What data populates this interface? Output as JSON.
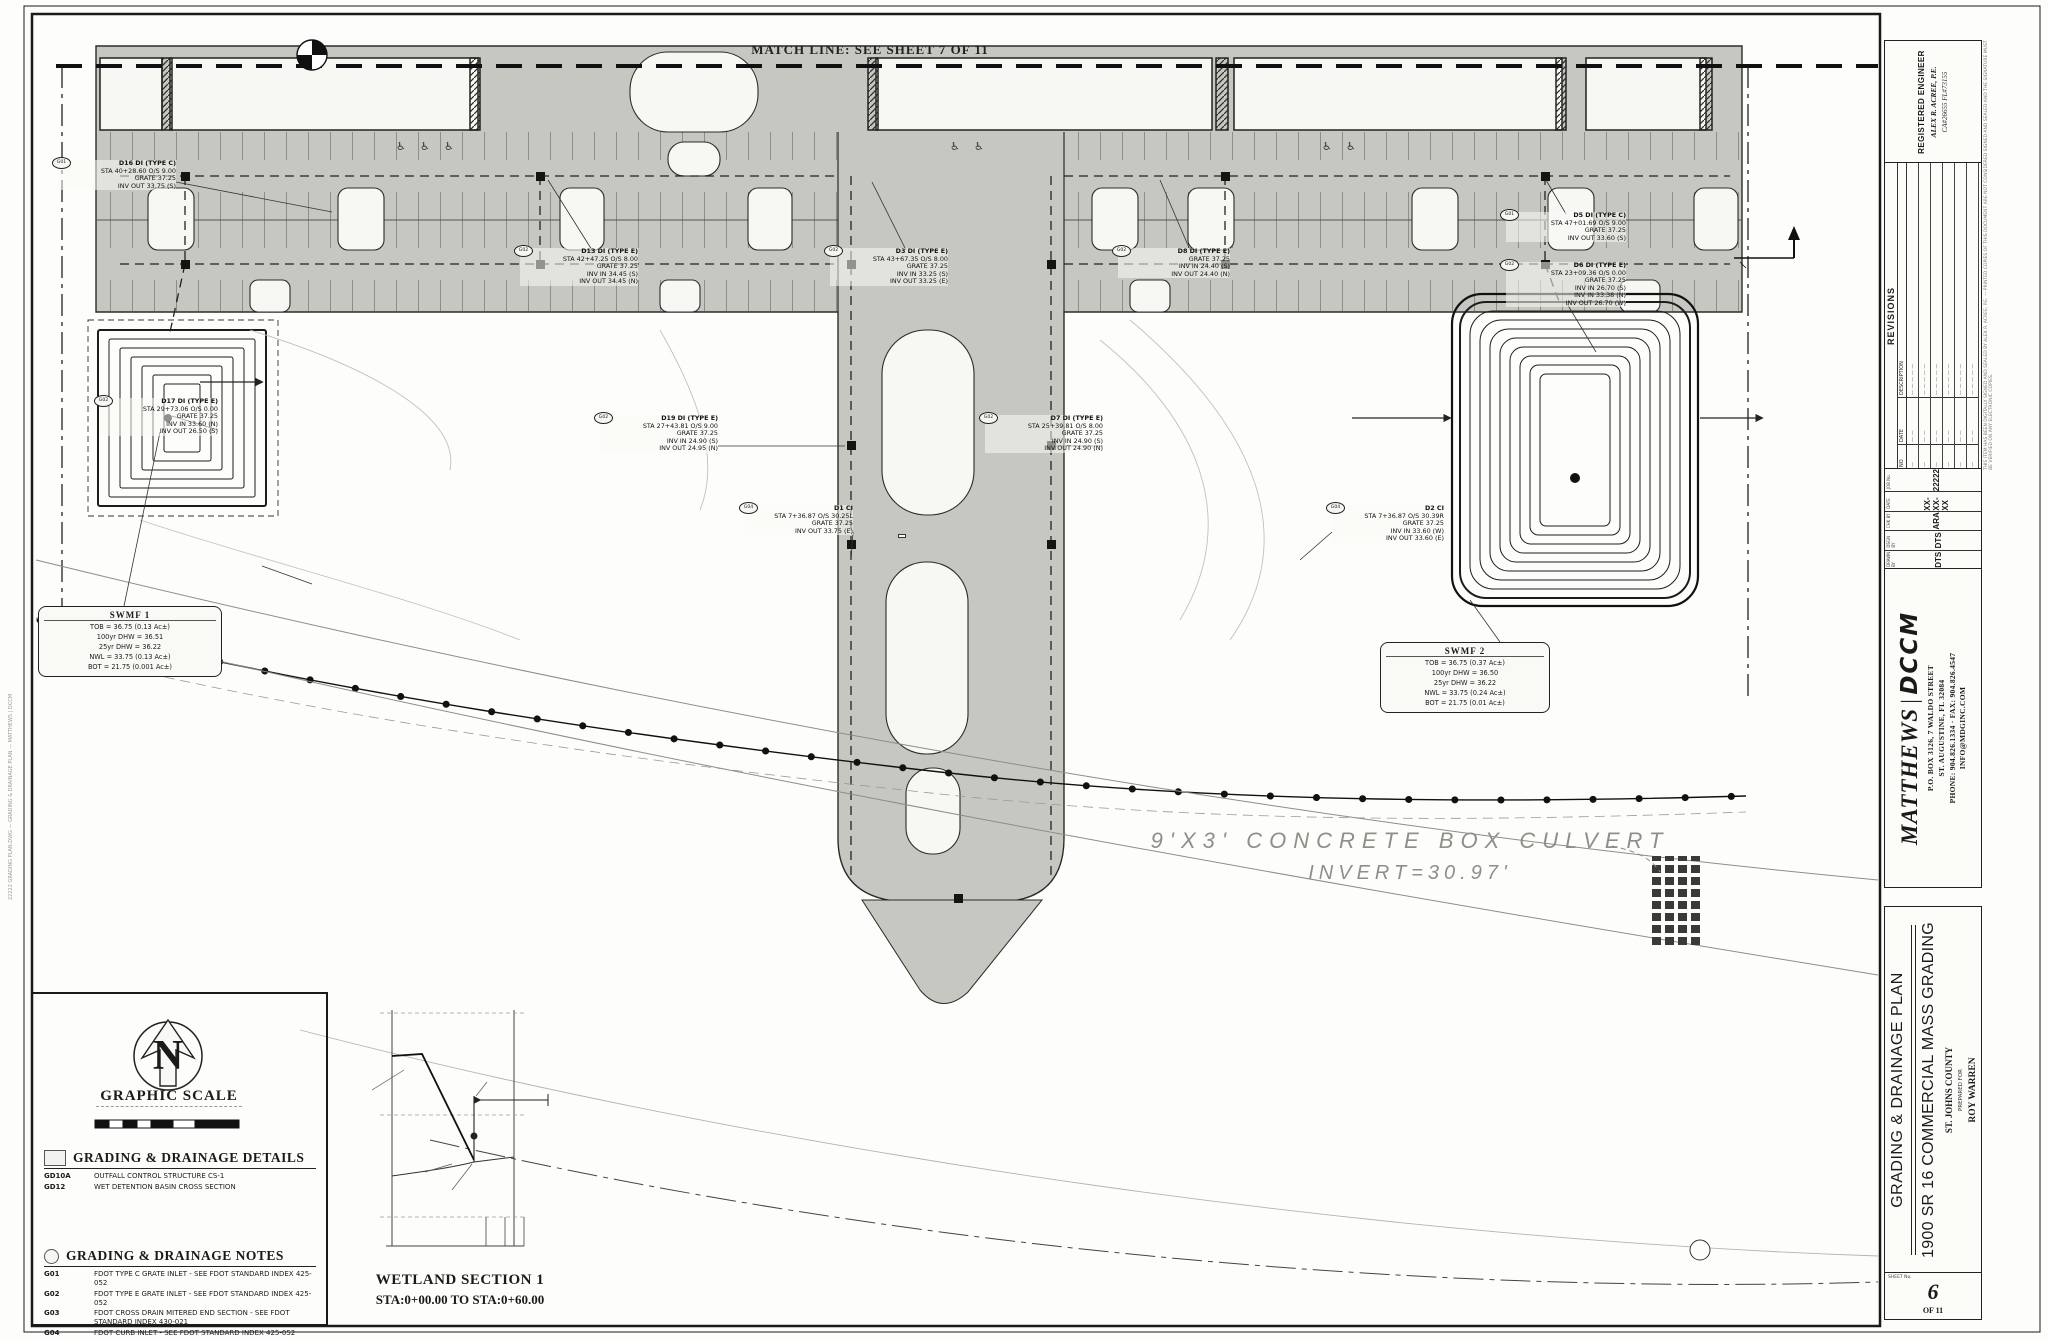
{
  "sheet": {
    "match_line_label": "MATCH LINE: SEE SHEET 7 OF 11",
    "culvert_line1": "9'X3' CONCRETE BOX CULVERT",
    "culvert_line2": "INVERT=30.97'",
    "plot_stamp": "22222 GRADING PLAN.DWG — GRADING & DRAINAGE PLAN — MATTHEWS | DCCM",
    "accessible_icon": "♿"
  },
  "legend": {
    "north": "N",
    "graphic_scale_title": "GRAPHIC SCALE",
    "scale_note": "1\" = 30'",
    "details_title": "GRADING & DRAINAGE DETAILS",
    "details": [
      {
        "code": "GD10A",
        "text": "OUTFALL CONTROL STRUCTURE CS-1"
      },
      {
        "code": "GD12",
        "text": "WET DETENTION BASIN CROSS SECTION"
      }
    ],
    "notes_title": "GRADING & DRAINAGE NOTES",
    "notes": [
      {
        "code": "G01",
        "text": "FDOT TYPE C GRATE INLET - SEE FDOT STANDARD INDEX 425-052"
      },
      {
        "code": "G02",
        "text": "FDOT TYPE E GRATE INLET - SEE FDOT STANDARD INDEX 425-052"
      },
      {
        "code": "G03",
        "text": "FDOT CROSS DRAIN MITERED END SECTION - SEE FDOT STANDARD INDEX 430-021"
      },
      {
        "code": "G04",
        "text": "FDOT CURB INLET - SEE FDOT STANDARD INDEX 425-052"
      }
    ]
  },
  "wetland_section": {
    "title_line1": "WETLAND SECTION 1",
    "title_line2": "STA:0+00.00 TO STA:0+60.00"
  },
  "swmf_boxes": [
    {
      "x": 38,
      "y": 606,
      "w": 172,
      "title": "SWMF 1",
      "lines": [
        "TOB = 36.75 (0.13 Ac±)",
        "100yr DHW = 36.51",
        "25yr DHW = 36.22",
        "NWL = 33.75 (0.13 Ac±)",
        "BOT = 21.75 (0.001 Ac±)"
      ]
    },
    {
      "x": 1380,
      "y": 642,
      "w": 158,
      "title": "SWMF 2",
      "lines": [
        "TOB = 36.75 (0.37 Ac±)",
        "100yr DHW = 36.50",
        "25yr DHW = 36.22",
        "NWL = 33.75 (0.24 Ac±)",
        "BOT = 21.75 (0.01 Ac±)"
      ]
    }
  ],
  "callouts": [
    {
      "x": 58,
      "y": 160,
      "w": 118,
      "code": "G01",
      "lines": [
        "D16 DI (TYPE C)",
        "STA 40+28.60 O/S 9.00",
        "GRATE 37.25",
        "INV OUT 33.75 (S)"
      ]
    },
    {
      "x": 520,
      "y": 248,
      "w": 118,
      "code": "G02",
      "lines": [
        "D13 DI (TYPE E)",
        "STA 42+47.25 O/S 8.00",
        "GRATE 37.25",
        "INV IN 34.45 (S)",
        "INV OUT 34.45 (N)"
      ]
    },
    {
      "x": 830,
      "y": 248,
      "w": 118,
      "code": "G02",
      "lines": [
        "D3 DI (TYPE E)",
        "STA 43+67.35 O/S 8.00",
        "GRATE 37.25",
        "INV IN 33.25 (S)",
        "INV OUT 33.25 (E)"
      ]
    },
    {
      "x": 1118,
      "y": 248,
      "w": 112,
      "code": "G02",
      "lines": [
        "D8 DI (TYPE E)",
        "GRATE 37.25",
        "INV IN 24.40 (S)",
        "INV OUT 24.40 (N)"
      ]
    },
    {
      "x": 1506,
      "y": 212,
      "w": 120,
      "code": "G01",
      "lines": [
        "D5 DI (TYPE C)",
        "STA 47+01.69 O/S 9.00",
        "GRATE 37.25",
        "INV OUT 33.60 (S)"
      ]
    },
    {
      "x": 1506,
      "y": 262,
      "w": 120,
      "code": "G02",
      "lines": [
        "D6 DI (TYPE E)",
        "STA 23+09.36 O/S 0.00",
        "GRATE 37.25",
        "INV IN 26.70 (S)",
        "INV IN 33.38 (N)",
        "INV OUT 26.70 (W)"
      ]
    },
    {
      "x": 100,
      "y": 398,
      "w": 118,
      "code": "G02",
      "lines": [
        "D17 DI (TYPE E)",
        "STA 29+73.06 O/S 0.00",
        "GRATE 37.25",
        "INV IN 33.60 (N)",
        "INV OUT 26.50 (S)"
      ]
    },
    {
      "x": 600,
      "y": 415,
      "w": 118,
      "code": "G02",
      "lines": [
        "D19 DI (TYPE E)",
        "STA 27+43.81 O/S 9.00",
        "GRATE 37.25",
        "INV IN 24.90 (S)",
        "INV OUT 24.95 (N)"
      ]
    },
    {
      "x": 985,
      "y": 415,
      "w": 118,
      "code": "G02",
      "lines": [
        "D7 DI (TYPE E)",
        "STA 25+39.81 O/S 8.00",
        "GRATE 37.25",
        "INV IN 24.90 (S)",
        "INV OUT 24.90 (N)"
      ]
    },
    {
      "x": 745,
      "y": 505,
      "w": 108,
      "code": "G04",
      "lines": [
        "D1 CI",
        "STA 7+36.87 O/S 30.25L",
        "GRATE 37.25",
        "INV OUT 33.75 (E)"
      ]
    },
    {
      "x": 1332,
      "y": 505,
      "w": 112,
      "code": "G04",
      "lines": [
        "D2 CI",
        "STA 7+36.87 O/S 30.39R",
        "GRATE 37.25",
        "INV IN 33.60 (W)",
        "INV OUT 33.60 (E)"
      ]
    }
  ],
  "pipes": [
    {
      "x": 836,
      "y": 162,
      "lines": [
        "18\" PP",
        "65 LF @ 0.24%"
      ]
    },
    {
      "x": 898,
      "y": 534,
      "boxed": true,
      "lines": [
        "16\" PP",
        "61 LF @ 0.25%"
      ]
    },
    {
      "x": 1282,
      "y": 322,
      "lines": [
        "20\" PP",
        "229 LF @ 0.41%"
      ]
    },
    {
      "x": 262,
      "y": 302,
      "lines": [
        "30\" PP",
        "225 LF @ 0.41%"
      ]
    },
    {
      "x": 176,
      "y": 330,
      "rot": -78,
      "lines": [
        "24\" PP @ 0.41%"
      ]
    },
    {
      "x": 1216,
      "y": 335,
      "rot": -80,
      "lines": [
        "24\" PP @ 0.45%"
      ]
    }
  ],
  "spots": [
    {
      "x": 28,
      "y": 84,
      "label": "(38.3)"
    },
    {
      "x": 44,
      "y": 102,
      "label": "(37.3)"
    },
    {
      "x": 50,
      "y": 122,
      "label": "(38.0)"
    },
    {
      "x": 8,
      "y": 134,
      "label": "(39.4)"
    },
    {
      "x": 16,
      "y": 150,
      "label": "(40.3)"
    },
    {
      "x": 26,
      "y": 240,
      "label": "(37.4)"
    },
    {
      "x": 38,
      "y": 256,
      "label": "(39.9)"
    },
    {
      "x": 42,
      "y": 271,
      "label": "(37.9)"
    },
    {
      "x": 10,
      "y": 432,
      "label": "(38.6)"
    },
    {
      "x": 22,
      "y": 450,
      "label": "(39.8)"
    },
    {
      "x": 8,
      "y": 554,
      "label": "(40.0)"
    },
    {
      "x": 1068,
      "y": 136,
      "label": "(31.3)"
    },
    {
      "x": 1264,
      "y": 186,
      "label": "(31.8)"
    },
    {
      "x": 1476,
      "y": 224,
      "label": "(32.3)"
    },
    {
      "x": 1688,
      "y": 70,
      "label": "(33.2)"
    },
    {
      "x": 1736,
      "y": 76,
      "label": "(33.3)"
    },
    {
      "x": 1794,
      "y": 80,
      "label": "(33.4)"
    },
    {
      "x": 1174,
      "y": 268,
      "label": "(31.6)"
    },
    {
      "x": 1462,
      "y": 292,
      "label": "(32.2)"
    },
    {
      "x": 1348,
      "y": 278,
      "label": "(33.0)"
    },
    {
      "x": 1756,
      "y": 288,
      "label": "(32.5)"
    },
    {
      "x": 1552,
      "y": 332,
      "label": "(32.9)"
    },
    {
      "x": 1792,
      "y": 372,
      "label": "(32.1)"
    },
    {
      "x": 1142,
      "y": 368,
      "label": "(31.2)"
    },
    {
      "x": 1400,
      "y": 396,
      "label": "(32.4)"
    },
    {
      "x": 1194,
      "y": 474,
      "label": "(31.0)"
    },
    {
      "x": 1394,
      "y": 494,
      "label": "(31.9)"
    },
    {
      "x": 1178,
      "y": 558,
      "label": "(30.7)"
    },
    {
      "x": 1566,
      "y": 628,
      "label": "(32.5)"
    },
    {
      "x": 964,
      "y": 538,
      "label": "(33.5)"
    },
    {
      "x": 788,
      "y": 492,
      "label": "(34.1)"
    },
    {
      "x": 796,
      "y": 566,
      "label": "(34.8)"
    },
    {
      "x": 948,
      "y": 600,
      "label": "(31.4)"
    },
    {
      "x": 858,
      "y": 634,
      "label": "(34.9)"
    },
    {
      "x": 940,
      "y": 642,
      "label": "(31.6)"
    },
    {
      "x": 552,
      "y": 562,
      "label": "(36.5)"
    },
    {
      "x": 590,
      "y": 556,
      "label": "(36.4)"
    },
    {
      "x": 658,
      "y": 508,
      "label": "(35.7)"
    },
    {
      "x": 516,
      "y": 624,
      "label": "(36.9)"
    },
    {
      "x": 245,
      "y": 758,
      "label": "(38.18)",
      "op": 0.5
    },
    {
      "x": 310,
      "y": 784,
      "label": "(39.86)",
      "op": 0.5
    },
    {
      "x": 152,
      "y": 810,
      "label": "(39.44)",
      "op": 0.5
    },
    {
      "x": 540,
      "y": 834,
      "label": "(38.19)",
      "op": 0.5
    },
    {
      "x": 548,
      "y": 868,
      "label": "(38.61)",
      "op": 0.5
    },
    {
      "x": 738,
      "y": 898,
      "label": "(37.93)",
      "op": 0.5
    },
    {
      "x": 1026,
      "y": 928,
      "label": "(37.91)",
      "op": 0.5
    },
    {
      "x": 1168,
      "y": 948,
      "label": "(37.81)",
      "op": 0.5
    },
    {
      "x": 1148,
      "y": 1030,
      "label": "(38.54)",
      "op": 0.5
    }
  ],
  "micro": [
    {
      "x": 366,
      "y": 1007,
      "label": "40",
      "fs": 9
    },
    {
      "x": 527,
      "y": 1007,
      "label": "40",
      "fs": 9
    },
    {
      "x": 366,
      "y": 1109,
      "label": "35",
      "fs": 9
    },
    {
      "x": 527,
      "y": 1109,
      "label": "35",
      "fs": 9
    },
    {
      "x": 366,
      "y": 1211,
      "label": "30",
      "fs": 9
    },
    {
      "x": 527,
      "y": 1211,
      "label": "30",
      "fs": 9
    },
    {
      "x": 379,
      "y": 1250,
      "label": "0+00",
      "fs": 9
    },
    {
      "x": 497,
      "y": 1250,
      "label": "0+60",
      "fs": 9
    },
    {
      "x": 328,
      "y": 1084,
      "label": "PROPOSED GRADE",
      "fs": 7
    },
    {
      "x": 480,
      "y": 1079,
      "label": "SILT FENCE",
      "fs": 7
    },
    {
      "x": 553,
      "y": 1095,
      "label": "WETLAND",
      "fs": 7
    },
    {
      "x": 350,
      "y": 1169,
      "label": "EXISTING GRADE",
      "fs": 7
    },
    {
      "x": 397,
      "y": 1188,
      "label": "WETLAND LINE",
      "fs": 7
    },
    {
      "x": 427,
      "y": 1098,
      "label": "-18.22%",
      "fs": 6,
      "rot": 62
    },
    {
      "x": 398,
      "y": 1242,
      "label": "EG:37.5",
      "fs": 5,
      "rot": -90
    },
    {
      "x": 407,
      "y": 1242,
      "label": "PG:37.98",
      "fs": 5,
      "rot": -90
    },
    {
      "x": 492,
      "y": 1242,
      "label": "EG:",
      "fs": 5,
      "rot": -90
    },
    {
      "x": 501,
      "y": 1242,
      "label": "PG:32.68",
      "fs": 5,
      "rot": -90
    },
    {
      "x": 511,
      "y": 1242,
      "label": "EG:",
      "fs": 5,
      "rot": -90
    },
    {
      "x": 520,
      "y": 1242,
      "label": "PG:32.78",
      "fs": 5,
      "rot": -90
    },
    {
      "x": 336,
      "y": 164,
      "label": "41+00",
      "fs": 5
    },
    {
      "x": 476,
      "y": 164,
      "label": "42+00",
      "fs": 5
    },
    {
      "x": 616,
      "y": 164,
      "label": "43+00",
      "fs": 5
    },
    {
      "x": 756,
      "y": 164,
      "label": "44+00",
      "fs": 5
    },
    {
      "x": 1096,
      "y": 164,
      "label": "45+00",
      "fs": 5
    },
    {
      "x": 1236,
      "y": 164,
      "label": "46+00",
      "fs": 5
    },
    {
      "x": 1496,
      "y": 164,
      "label": "47+00",
      "fs": 5
    },
    {
      "x": 606,
      "y": 252,
      "label": "27+00",
      "fs": 5
    },
    {
      "x": 746,
      "y": 252,
      "label": "26+00",
      "fs": 5
    },
    {
      "x": 1086,
      "y": 252,
      "label": "25+00",
      "fs": 5
    },
    {
      "x": 1296,
      "y": 252,
      "label": "24+00",
      "fs": 5
    },
    {
      "x": 1536,
      "y": 252,
      "label": "23+00",
      "fs": 5
    },
    {
      "x": 316,
      "y": 578,
      "label": "PROPOSED 6' WOODEN FENCE",
      "fs": 7
    },
    {
      "x": 316,
      "y": 588,
      "label": "WITH 4' LOCKING GATE",
      "fs": 7
    },
    {
      "x": 1752,
      "y": 262,
      "label": "WETLAND SECTION 1",
      "fs": 7
    },
    {
      "x": 1694,
      "y": 1246,
      "label": "18",
      "fs": 8
    }
  ],
  "access_icon_positions": [
    {
      "x": 396,
      "y": 140
    },
    {
      "x": 420,
      "y": 140
    },
    {
      "x": 444,
      "y": 140
    },
    {
      "x": 950,
      "y": 140
    },
    {
      "x": 974,
      "y": 140
    },
    {
      "x": 1322,
      "y": 140
    },
    {
      "x": 1346,
      "y": 140
    }
  ],
  "scale_bar": {
    "ticks": [
      {
        "x": 92,
        "y": 1112,
        "label": "0",
        "fs": 8
      },
      {
        "x": 140,
        "y": 1112,
        "label": "30'",
        "fs": 8
      },
      {
        "x": 184,
        "y": 1112,
        "label": "45'",
        "fs": 8
      },
      {
        "x": 228,
        "y": 1112,
        "label": "60'",
        "fs": 8
      },
      {
        "x": 152,
        "y": 1140,
        "label": "1\" = 30'",
        "fs": 8
      }
    ]
  },
  "titleblock": {
    "engineer_line1": "REGISTERED ENGINEER",
    "engineer_line2": "ALEX R. ACREE, P.E.",
    "engineer_line3": "CA#26655  FL#73155",
    "seal_note": "THIS ITEM HAS BEEN DIGITALLY SIGNED AND SEALED BY ALEX R. ACREE, P.E. — PRINTED COPIES OF THIS DOCUMENT ARE NOT CONSIDERED SIGNED AND SEALED AND THE SIGNATURE MUST BE VERIFIED ON ANY ELECTRONIC COPIES.",
    "revisions": {
      "title": "REVISIONS",
      "col_no": "NO",
      "col_date": "DATE",
      "col_desc": "DESCRIPTION",
      "rows": [
        {
          "no": "—",
          "date": "— —",
          "desc": "— — — — —"
        },
        {
          "no": "—",
          "date": "— —",
          "desc": "— — — — —"
        },
        {
          "no": "—",
          "date": "— —",
          "desc": "— — — — —"
        },
        {
          "no": "—",
          "date": "— —",
          "desc": "— — — — —"
        },
        {
          "no": "—",
          "date": "— —",
          "desc": "— — — — —"
        },
        {
          "no": "—",
          "date": "— —",
          "desc": "— — — — —"
        }
      ]
    },
    "meta": [
      {
        "label": "DRAWN BY",
        "value": "DTS"
      },
      {
        "label": "DSGN BY",
        "value": "DTS"
      },
      {
        "label": "CHK BY",
        "value": "ARA"
      },
      {
        "label": "DATE",
        "value": "XX-XX-XX"
      },
      {
        "label": "JOB No.",
        "value": "22222"
      }
    ],
    "firm_name": "MATTHEWS",
    "firm_brand": "DCCM",
    "firm_bar": "|",
    "address1": "P.O. BOX 3126, 7 WALDO STREET",
    "address2": "ST. AUGUSTINE, FL 32084",
    "address3": "PHONE: 904.826.1334  ·  FAX: 904.826.4547",
    "address4": "INFO@MDGINC.COM",
    "title1": "GRADING & DRAINAGE PLAN",
    "title2": "1900 SR 16 COMMERCIAL MASS GRADING",
    "county": "ST. JOHNS COUNTY",
    "prepared_for": "PREPARED FOR",
    "client": "ROY WARREN",
    "sheet_label": "SHEET No.",
    "sheet_number": "6",
    "sheet_of": "OF 11"
  }
}
